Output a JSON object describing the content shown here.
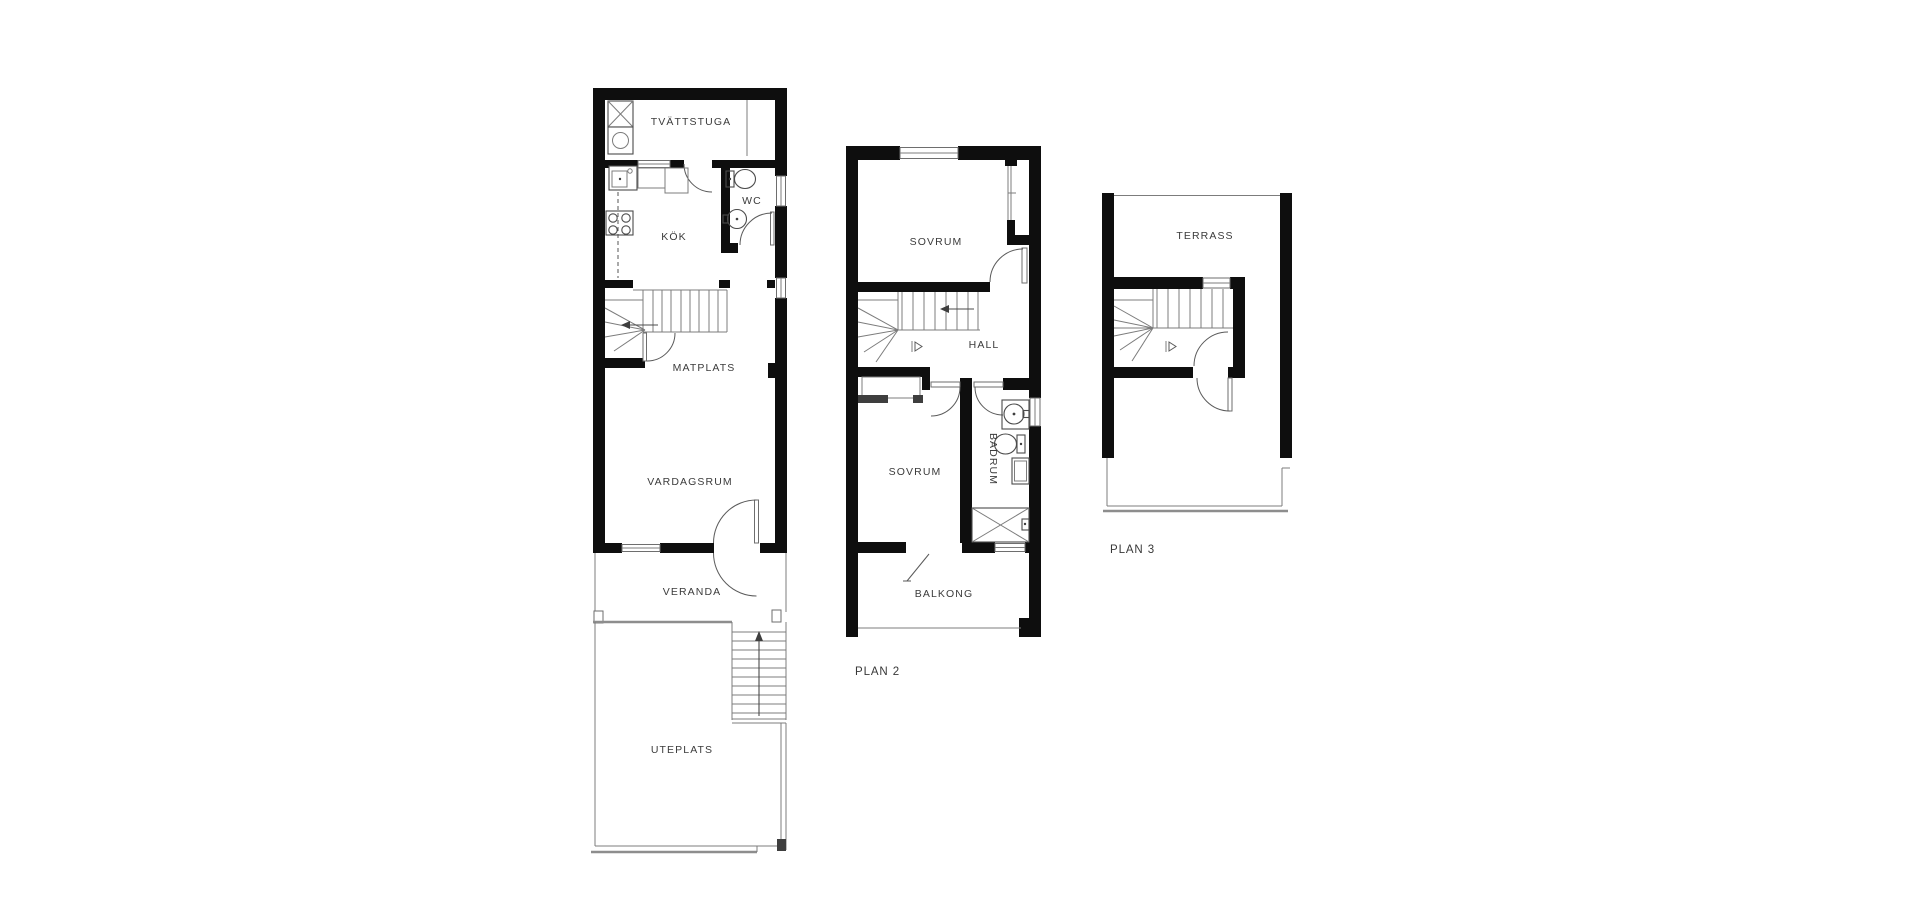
{
  "plan1": {
    "rooms": {
      "tvattstuga": "TVÄTTSTUGA",
      "wc": "WC",
      "kok": "KÖK",
      "matplats": "MATPLATS",
      "vardagsrum": "VARDAGSRUM",
      "veranda": "VERANDA",
      "uteplats": "UTEPLATS"
    }
  },
  "plan2": {
    "label": "PLAN 2",
    "rooms": {
      "sovrum_top": "SOVRUM",
      "hall": "HALL",
      "sovrum_bottom": "SOVRUM",
      "badrum": "BADRUM",
      "balkong": "BALKONG"
    }
  },
  "plan3": {
    "label": "PLAN 3",
    "rooms": {
      "terrass": "TERRASS"
    }
  },
  "colors": {
    "background": "#ffffff",
    "wall": "#0e0e0e",
    "thin_line": "#7c7c7c",
    "fixture_line": "#4b4b4b",
    "text": "#3b3b3b"
  }
}
